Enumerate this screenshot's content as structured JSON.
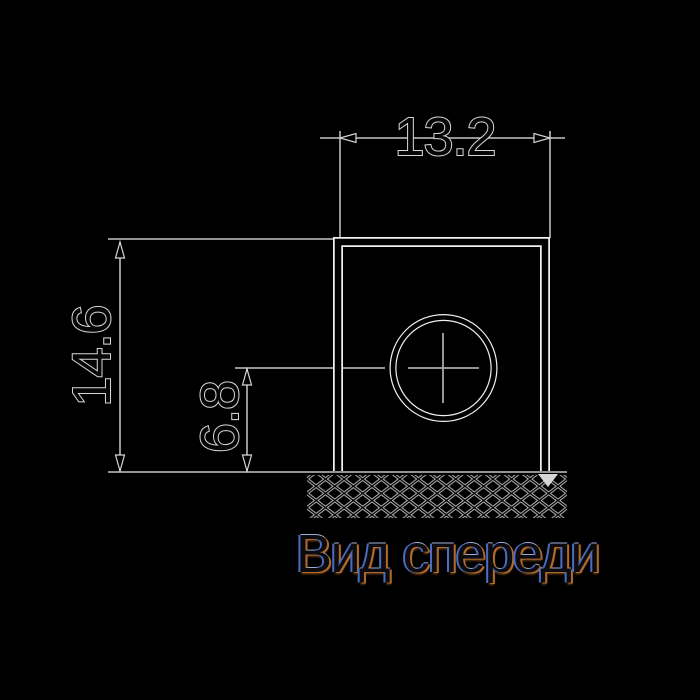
{
  "title": "Вид спереди",
  "labels": {
    "width": "13.2",
    "height": "14.6",
    "hole_height": "6.8"
  },
  "colors": {
    "background": "#000000",
    "thin_line": "#a8a8a8",
    "halo_white": "#f0f0f0",
    "stroke_core": "#000000",
    "text_fill": "#060606",
    "text_outline": "#d6d6d6",
    "hatch_line": "#c8c8c8",
    "title_text": "#0b0b10",
    "title_fringe_left": "#4c6cc0",
    "title_fringe_right": "#b26a2c",
    "title_fringe_top": "#9fb0d8",
    "title_fringe_bottom": "#7a4a18"
  },
  "drawing": {
    "thin_lines": [
      {
        "name": "width-ext-line-left",
        "x1": 340,
        "y1": 131,
        "x2": 340,
        "y2": 238
      },
      {
        "name": "width-ext-line-right",
        "x1": 550,
        "y1": 131,
        "x2": 550,
        "y2": 238
      },
      {
        "name": "width-dim-line",
        "x1": 320,
        "y1": 138,
        "x2": 565,
        "y2": 138
      },
      {
        "name": "height-ext-line-top",
        "x1": 108,
        "y1": 239,
        "x2": 338,
        "y2": 239
      },
      {
        "name": "height-dim-line",
        "x1": 120,
        "y1": 242,
        "x2": 120,
        "y2": 471
      },
      {
        "name": "ground-line",
        "x1": 108,
        "y1": 472,
        "x2": 567,
        "y2": 472
      },
      {
        "name": "hole-dim-line",
        "x1": 247,
        "y1": 368,
        "x2": 247,
        "y2": 471
      },
      {
        "name": "hole-ext-line",
        "x1": 235,
        "y1": 368,
        "x2": 385,
        "y2": 368
      },
      {
        "name": "hole-crosshair-h",
        "x1": 408,
        "y1": 368,
        "x2": 479,
        "y2": 368
      },
      {
        "name": "hole-crosshair-v",
        "x1": 443,
        "y1": 333,
        "x2": 443,
        "y2": 403
      }
    ],
    "outline": {
      "x": 338,
      "y": 242,
      "w": 207,
      "h": 229
    },
    "circle": {
      "cx": 443.5,
      "cy": 368,
      "r": 50.5
    },
    "arrows": [
      {
        "name": "width-arrow-left",
        "x": 340,
        "y": 138,
        "dir": "left"
      },
      {
        "name": "width-arrow-right",
        "x": 550,
        "y": 138,
        "dir": "right"
      },
      {
        "name": "height-arrow-top",
        "x": 120,
        "y": 242,
        "dir": "up"
      },
      {
        "name": "height-arrow-bottom",
        "x": 120,
        "y": 471,
        "dir": "down"
      },
      {
        "name": "hole-arrow-top",
        "x": 247,
        "y": 369,
        "dir": "up"
      },
      {
        "name": "hole-arrow-bottom",
        "x": 247,
        "y": 471,
        "dir": "down"
      }
    ],
    "marker_triangle": {
      "points": "538,474 558,474 548,487"
    },
    "hatch_band": {
      "x": 307,
      "y": 475,
      "w": 260,
      "h": 43
    },
    "hatch_cell": {
      "w": 18.6,
      "h": 14.3
    }
  }
}
